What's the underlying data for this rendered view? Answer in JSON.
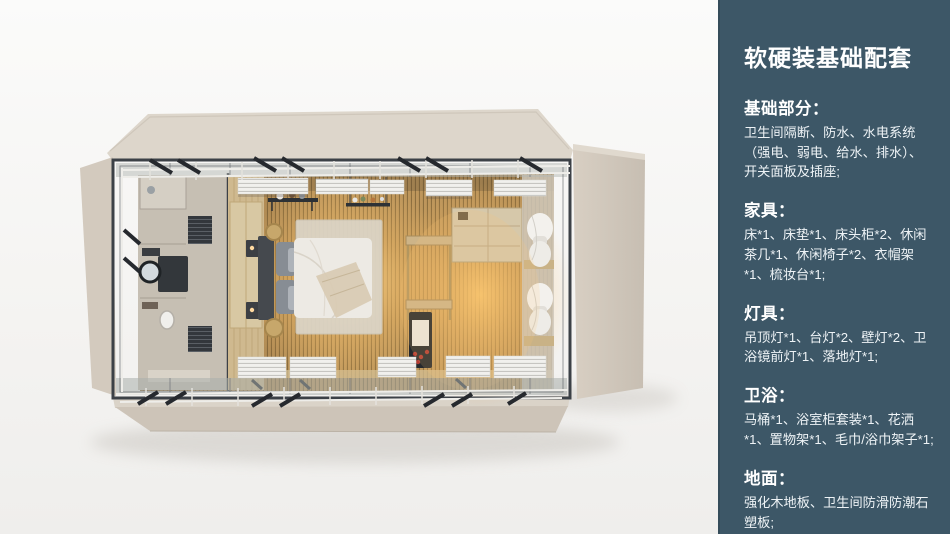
{
  "panel": {
    "accent_bg": "#3d5767",
    "text_color": "#ffffff",
    "title": "软硬装基础配套",
    "sections": [
      {
        "heading": "基础部分：",
        "body": "卫生间隔断、防水、水电系统（强电、弱电、给水、排水）、开关面板及插座;"
      },
      {
        "heading": "家具：",
        "body": "床*1、床垫*1、床头柜*2、休闲茶几*1、休闲椅子*2、衣帽架*1、梳妆台*1;"
      },
      {
        "heading": "灯具：",
        "body": "吊顶灯*1、台灯*2、壁灯*2、卫浴镜前灯*1、落地灯*1;"
      },
      {
        "heading": "卫浴：",
        "body": "马桶*1、浴室柜套装*1、花洒*1、置物架*1、毛巾/浴巾架子*1;"
      },
      {
        "heading": "地面：",
        "body": "强化木地板、卫生间防滑防潮石塑板;"
      }
    ]
  },
  "render": {
    "subject": "top-down-3d-room-render",
    "shell_color": "#d5ccc0",
    "floor_wood_color": "#c29a5e",
    "glow_color": "#f6c97e"
  }
}
